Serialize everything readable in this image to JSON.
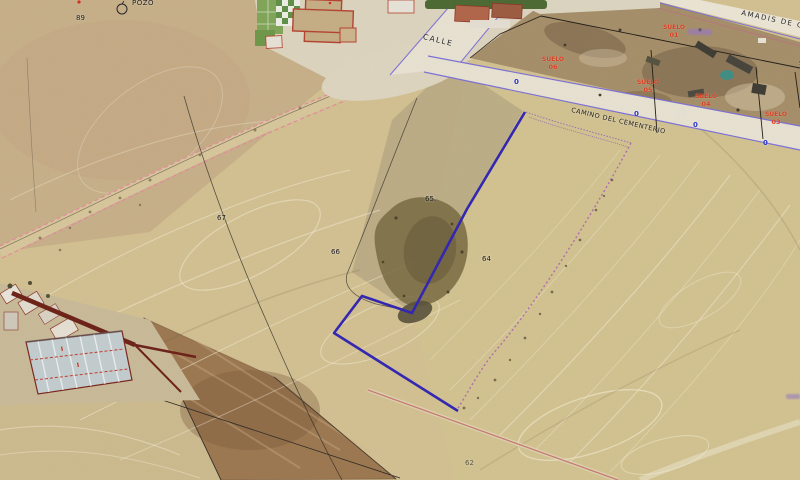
{
  "title": "Cadastral aerial map view",
  "poi": {
    "pozo": "POZO"
  },
  "streets": {
    "calle": "CALLE",
    "camino": "CAMINO DEL CEMENTERIO",
    "amadis": "AMADIS  DE  GAULA"
  },
  "parcels": {
    "p89": "89",
    "p67": "67",
    "p66": "66",
    "p65": "65.",
    "p64": "64",
    "p62": "62"
  },
  "suelo": {
    "s01": {
      "label": "SUELO",
      "num": "01"
    },
    "s03": {
      "label": "SUELO",
      "num": "03"
    },
    "s04": {
      "label": "SUELO",
      "num": "04"
    },
    "s05": {
      "label": "SUELO",
      "num": "05"
    },
    "s06": {
      "label": "SUELO",
      "num": "06"
    },
    "edge": {
      "label": "SU"
    }
  },
  "road_markers": {
    "m1": "0",
    "m2": "0",
    "m3": "0",
    "m4": "0"
  },
  "construction_marks": {
    "i1": "I",
    "i2": "I"
  },
  "colors": {
    "selection_blue": "#2f23b4",
    "label_red": "#d93c1e",
    "road_edge_purple": "#7b6fd8",
    "track_pink": "#e889a0",
    "via_magenta": "#b06cae",
    "marker_blue": "#2c35c9",
    "field_tan": "#d3c192",
    "plowed_brown": "#9c7750"
  }
}
